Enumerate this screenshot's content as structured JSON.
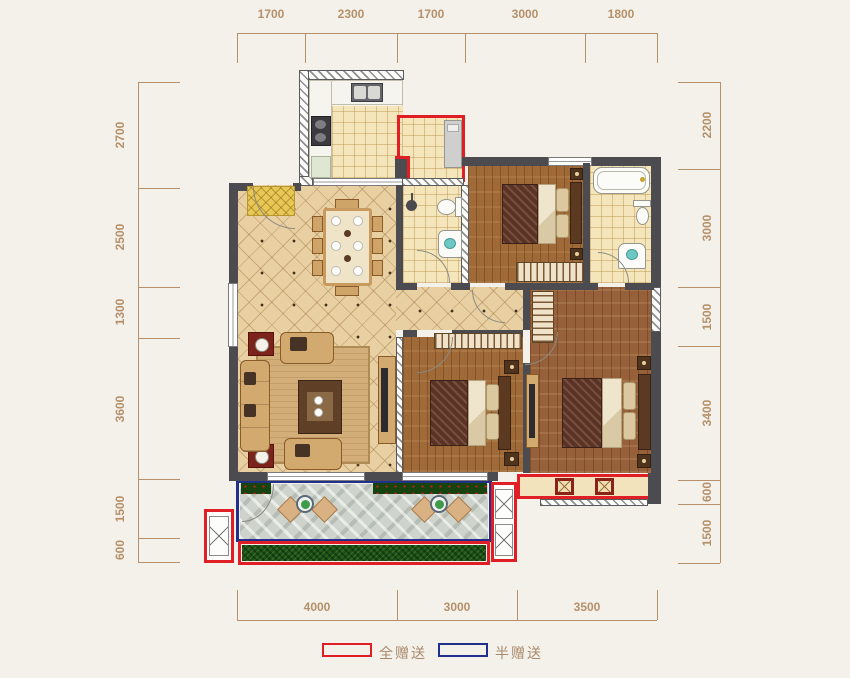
{
  "page": {
    "background": "#f4f1ea",
    "type": "apartment-floor-plan"
  },
  "dimensions": {
    "unit": "mm",
    "color": "#b5906a",
    "top": [
      "1700",
      "2300",
      "1700",
      "3000",
      "1800"
    ],
    "left": [
      "2700",
      "2500",
      "1300",
      "3600",
      "1500",
      "600"
    ],
    "right": [
      "2200",
      "3000",
      "1500",
      "3400",
      "600",
      "1500"
    ],
    "bottom": [
      "4000",
      "3000",
      "3500"
    ]
  },
  "legend": {
    "label_color": "#a8896b",
    "items": [
      {
        "swatch_color": "#e01e26",
        "label": "全赠送"
      },
      {
        "swatch_color": "#20308c",
        "label": "半赠送"
      }
    ]
  },
  "plan": {
    "colors": {
      "wall": "#4b4b50",
      "living_floor": "#e9d0a2",
      "wood_floor": "#a06a38",
      "tile_floor": "#f4e6ba",
      "balcony_stone": "#ced4cb",
      "greenery": "#1d5117",
      "gift_full_outline": "#e01e26",
      "gift_half_outline": "#20308c"
    },
    "fixtures": [
      "kitchen-sink-icon",
      "kitchen-stove-icon",
      "washing-machine-icon",
      "dining-table-icon",
      "sofa-icon",
      "coffee-table-icon",
      "tv-cabinet-icon",
      "entry-mat-icon",
      "double-bed-icon",
      "wardrobe-icon",
      "nightstand-icon",
      "toilet-icon",
      "washbasin-icon",
      "bathtub-icon",
      "shower-icon",
      "balcony-chair-icon",
      "planter-table-icon",
      "hedge-icon",
      "grass-strip-icon",
      "ac-platform-icon",
      "bay-window-stool-icon"
    ]
  }
}
